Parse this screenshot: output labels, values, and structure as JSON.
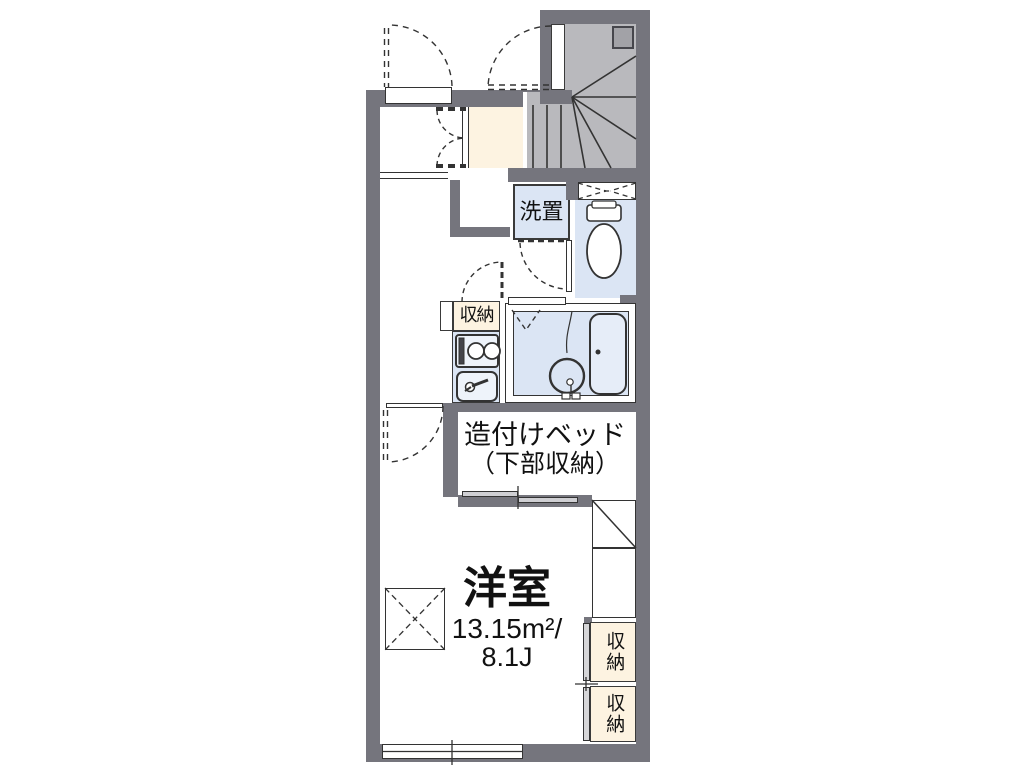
{
  "floorplan": {
    "labels": {
      "washer": "洗置",
      "hall_storage": "収納",
      "bed_line1": "造付けベッド",
      "bed_line2": "（下部収納）",
      "room_name": "洋室",
      "room_area_m2": "13.15m²/",
      "room_area_j": "8.1J",
      "closet_upper": "収納",
      "closet_lower": "収納"
    },
    "colors": {
      "wall_gray": "#75757d",
      "stair_floor_gray": "#b9b9bd",
      "genkan_cream": "#fdf3e1",
      "wet_area_blue": "#dbe5f4",
      "line_dark": "#333333",
      "background": "#ffffff"
    }
  }
}
